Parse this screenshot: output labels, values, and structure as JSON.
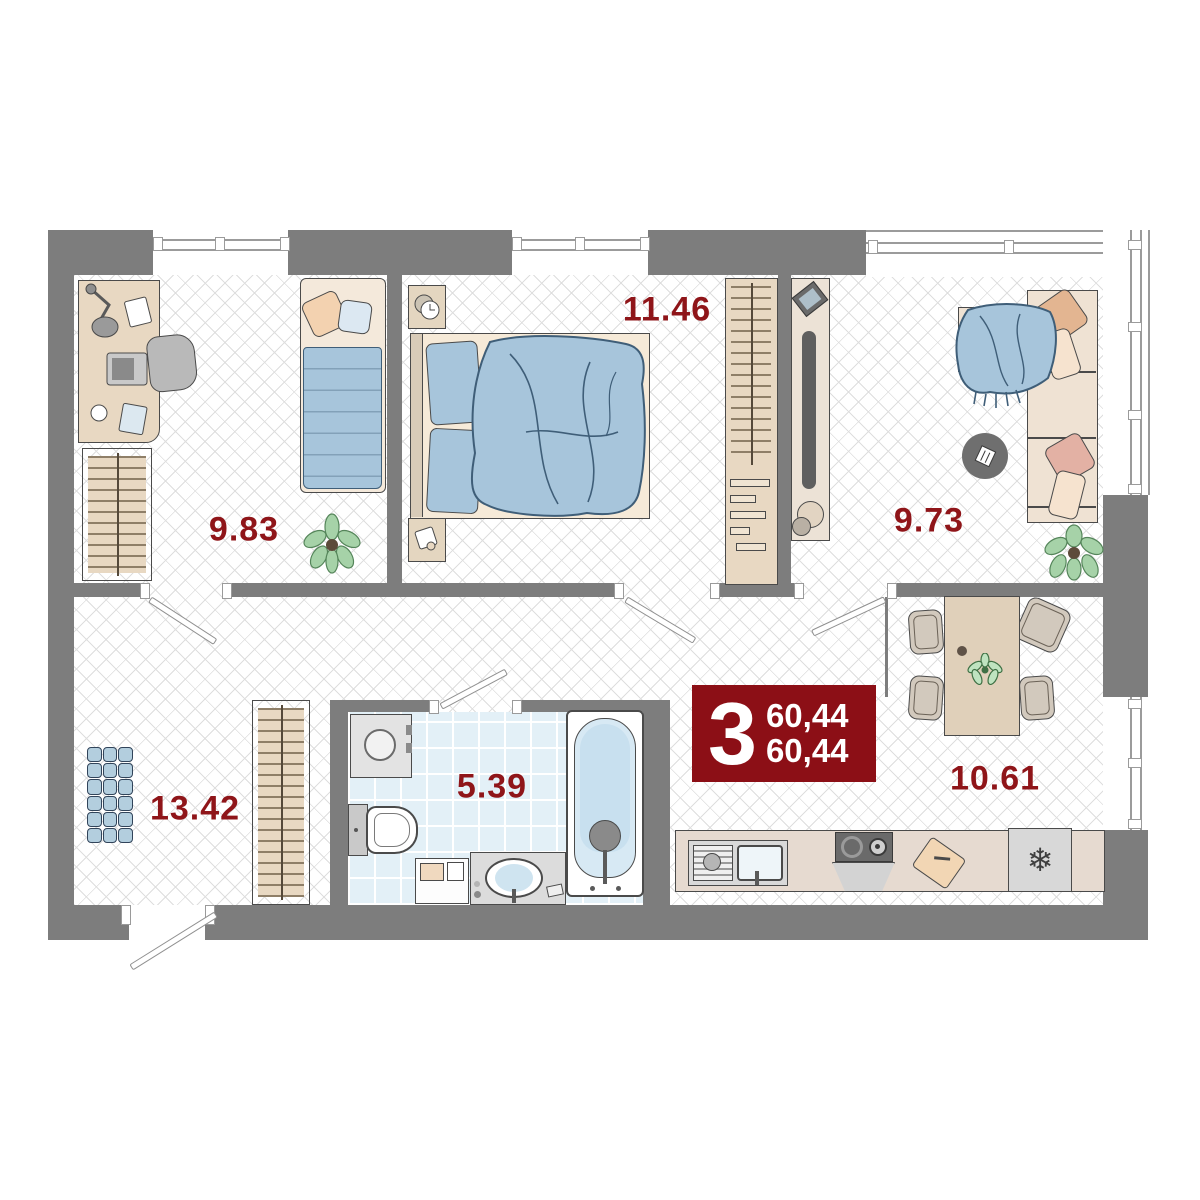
{
  "floorplan": {
    "type": "apartment-floor-plan",
    "badge": {
      "room_count": "3",
      "total_area": "60,44",
      "living_area": "60,44"
    },
    "rooms": [
      {
        "name": "bedroom-1",
        "area": "9.83"
      },
      {
        "name": "bedroom-2",
        "area": "11.46"
      },
      {
        "name": "living-room",
        "area": "9.73"
      },
      {
        "name": "hallway",
        "area": "13.42"
      },
      {
        "name": "bathroom",
        "area": "5.39"
      },
      {
        "name": "kitchen",
        "area": "10.61"
      }
    ],
    "icons": {
      "fridge_icon": "❄"
    },
    "colors": {
      "wall": "#7d7d7d",
      "accent_red": "#8c0f16",
      "label_red": "#8f1519",
      "floor_line": "#dedede",
      "furniture_beige": "#e8d8c2",
      "textile_blue": "#a7c5db",
      "bathroom_tile": "#e3f0f7"
    }
  }
}
